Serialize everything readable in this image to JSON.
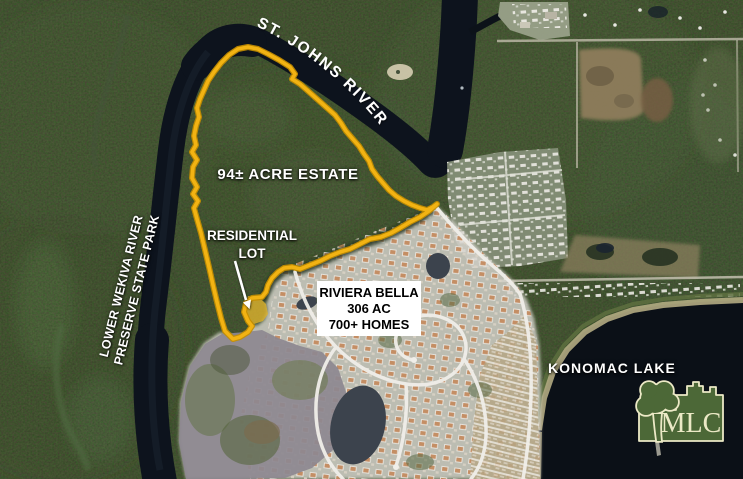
{
  "map": {
    "labels": {
      "river": "ST. JOHNS RIVER",
      "estate": "94± ACRE ESTATE",
      "lot_line1": "RESIDENTIAL",
      "lot_line2": "LOT",
      "preserve_line1": "LOWER WEKIVA RIVER",
      "preserve_line2": "PRESERVE STATE PARK",
      "lake": "KONOMAC LAKE"
    },
    "callout": {
      "line1": "RIVIERA BELLA",
      "line2": "306 AC",
      "line3": "700+ HOMES"
    },
    "logo": {
      "text": "MLC"
    },
    "colors": {
      "boundary": "#F2B313",
      "boundary_edge": "#C78F00",
      "lot_fill": "#E0B42E",
      "label_white": "#FFFFFF",
      "logo_green": "#4C6837",
      "logo_cream": "#ECE9C6"
    }
  }
}
